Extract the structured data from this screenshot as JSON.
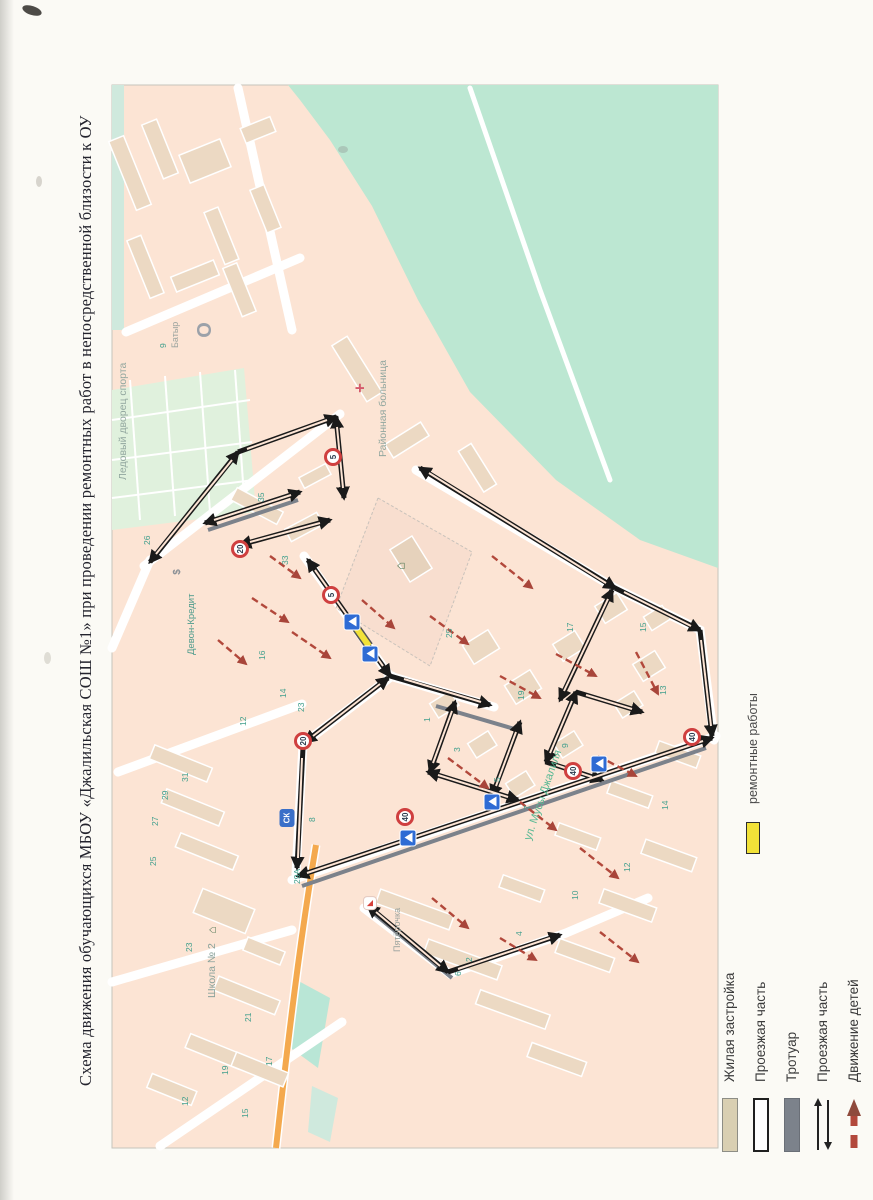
{
  "page": {
    "title": "Схема движения обучающихся МБОУ «Джалильская СОШ №1» при проведении ремонтных работ в непосредственной близости к ОУ"
  },
  "map": {
    "town": "Джалиль",
    "school_name": {
      "line1": "Джалильская",
      "line2": "СОШ №1"
    },
    "labels": [
      {
        "text": "Ледовый дворец спорта",
        "x": 117,
        "y": 480,
        "size": 10.5,
        "color": "#92a79f"
      },
      {
        "text": "Батыр",
        "x": 170,
        "y": 348,
        "size": 9,
        "color": "#9aa39e"
      },
      {
        "text": "Районная больница",
        "x": 377,
        "y": 457,
        "size": 10.5,
        "color": "#92a79f"
      },
      {
        "text": "Девон-Кредит",
        "x": 186,
        "y": 655,
        "size": 9.5,
        "color": "#4d9b8c"
      },
      {
        "text": "Школа № 2",
        "x": 206,
        "y": 998,
        "size": 10.5,
        "color": "#8aa29b"
      },
      {
        "text": "Пятёрочка",
        "x": 392,
        "y": 952,
        "size": 9,
        "color": "#9aa39e"
      },
      {
        "text": "ул. Мусы Джалиля",
        "x": 522,
        "y": 838,
        "size": 11,
        "color": "#58b893",
        "rot": -71
      }
    ],
    "house_numbers": [
      {
        "n": "26",
        "x": 142,
        "y": 545
      },
      {
        "n": "35",
        "x": 256,
        "y": 502
      },
      {
        "n": "33",
        "x": 280,
        "y": 565
      },
      {
        "n": "25",
        "x": 444,
        "y": 638
      },
      {
        "n": "14",
        "x": 278,
        "y": 698
      },
      {
        "n": "16",
        "x": 257,
        "y": 660
      },
      {
        "n": "12",
        "x": 238,
        "y": 726
      },
      {
        "n": "23",
        "x": 296,
        "y": 712
      },
      {
        "n": "31",
        "x": 180,
        "y": 782
      },
      {
        "n": "29",
        "x": 160,
        "y": 800
      },
      {
        "n": "27",
        "x": 150,
        "y": 826
      },
      {
        "n": "25",
        "x": 148,
        "y": 866
      },
      {
        "n": "23",
        "x": 184,
        "y": 952
      },
      {
        "n": "21",
        "x": 243,
        "y": 1022
      },
      {
        "n": "19",
        "x": 220,
        "y": 1075
      },
      {
        "n": "17",
        "x": 264,
        "y": 1066
      },
      {
        "n": "15",
        "x": 240,
        "y": 1118
      },
      {
        "n": "12",
        "x": 180,
        "y": 1106
      },
      {
        "n": "29А",
        "x": 292,
        "y": 884
      },
      {
        "n": "8",
        "x": 307,
        "y": 822
      },
      {
        "n": "1",
        "x": 422,
        "y": 722
      },
      {
        "n": "3",
        "x": 452,
        "y": 752
      },
      {
        "n": "5",
        "x": 492,
        "y": 782
      },
      {
        "n": "7",
        "x": 522,
        "y": 810
      },
      {
        "n": "9",
        "x": 560,
        "y": 748
      },
      {
        "n": "13",
        "x": 658,
        "y": 695
      },
      {
        "n": "15",
        "x": 638,
        "y": 632
      },
      {
        "n": "17",
        "x": 565,
        "y": 632
      },
      {
        "n": "19",
        "x": 516,
        "y": 700
      },
      {
        "n": "2",
        "x": 464,
        "y": 962
      },
      {
        "n": "4",
        "x": 514,
        "y": 936
      },
      {
        "n": "6",
        "x": 453,
        "y": 976
      },
      {
        "n": "10",
        "x": 570,
        "y": 900
      },
      {
        "n": "12",
        "x": 622,
        "y": 872
      },
      {
        "n": "14",
        "x": 660,
        "y": 810
      },
      {
        "n": "9",
        "x": 158,
        "y": 348
      }
    ],
    "signs": [
      {
        "type": "speed",
        "value": "20",
        "x": 240,
        "y": 549
      },
      {
        "type": "speed",
        "value": "5",
        "x": 333,
        "y": 457
      },
      {
        "type": "speed",
        "value": "5",
        "x": 331,
        "y": 595
      },
      {
        "type": "speed",
        "value": "20",
        "x": 303,
        "y": 741
      },
      {
        "type": "speed",
        "value": "40",
        "x": 405,
        "y": 817
      },
      {
        "type": "speed",
        "value": "40",
        "x": 573,
        "y": 771
      },
      {
        "type": "speed",
        "value": "40",
        "x": 692,
        "y": 737
      },
      {
        "type": "crosswalk",
        "x": 352,
        "y": 622
      },
      {
        "type": "crosswalk",
        "x": 370,
        "y": 654
      },
      {
        "type": "crosswalk",
        "x": 408,
        "y": 838
      },
      {
        "type": "crosswalk",
        "x": 492,
        "y": 802
      },
      {
        "type": "crosswalk",
        "x": 599,
        "y": 764
      },
      {
        "type": "poi-badge",
        "value": "СК",
        "x": 287,
        "y": 818
      }
    ],
    "pois": [
      {
        "name": "hospital-cross-icon",
        "text": "+",
        "x": 360,
        "y": 388,
        "size": 17,
        "color": "#d4596b",
        "weight": 700
      },
      {
        "name": "bank-icon",
        "text": "$",
        "x": 178,
        "y": 572,
        "size": 10,
        "color": "#8a9096",
        "weight": 700
      },
      {
        "name": "stadium-letter-icon",
        "text": "О",
        "x": 205,
        "y": 330,
        "size": 20,
        "color": "#9ba1a9",
        "weight": 700
      },
      {
        "name": "school-icon",
        "text": "⌂",
        "x": 400,
        "y": 566,
        "size": 13,
        "color": "#46724e",
        "weight": 700
      },
      {
        "name": "school2-icon",
        "text": "⌂",
        "x": 212,
        "y": 930,
        "size": 12,
        "color": "#46724e",
        "weight": 700
      },
      {
        "name": "pyaterochka-logo",
        "text": "◣",
        "x": 370,
        "y": 903,
        "size": 8,
        "color": "#d6403a",
        "box": true
      }
    ]
  },
  "legend": {
    "repair": {
      "label": "ремонтные работы"
    },
    "items": [
      {
        "label": "Жилая застройка",
        "swatch": "residential"
      },
      {
        "label": "Проезжая часть",
        "swatch": "roadway"
      },
      {
        "label": "Тротуар",
        "swatch": "sidewalk"
      },
      {
        "label": "Проезжая часть",
        "swatch": "road-arrows"
      },
      {
        "label": "Движение детей",
        "swatch": "children-arrow"
      }
    ]
  },
  "colors": {
    "map_background": "#fce4d4",
    "green_area": "#bce7d2",
    "residential": "#d9cfb2",
    "sidewalk": "#7c828b",
    "children_route": "#b2483b",
    "repair": "#f2e238",
    "orange_road": "#f4a94e"
  }
}
